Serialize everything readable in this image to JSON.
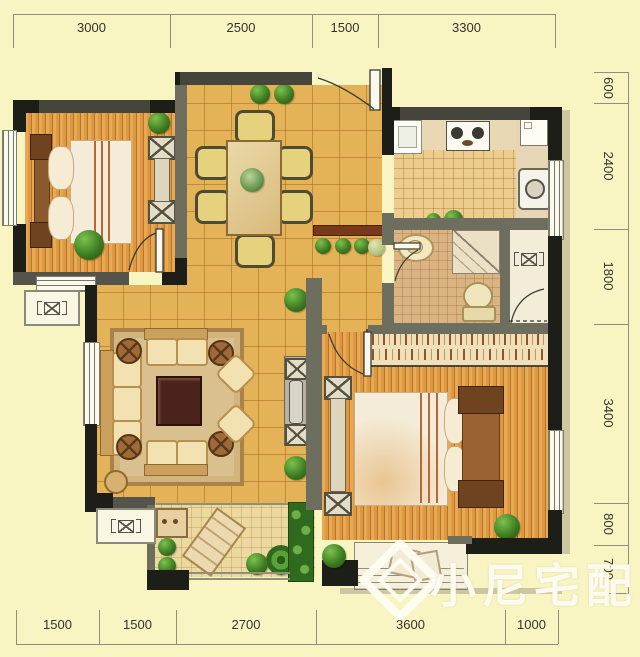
{
  "dimensions": {
    "top": [
      "3000",
      "2500",
      "1500",
      "3300"
    ],
    "right": [
      "600",
      "2400",
      "1800",
      "3400",
      "800",
      "700"
    ],
    "bottom": [
      "1500",
      "1500",
      "2700",
      "3600",
      "1000"
    ]
  },
  "watermark": {
    "text": "小尼宅配"
  },
  "colors": {
    "background": "#f9f5c3",
    "wall_exterior": "#1e1e18",
    "wall_interior": "#6e6e5f",
    "wood_floor": "#dd9840",
    "tile_floor": "#e4b257",
    "kitchen_tile": "#eccd8e",
    "bath_tile": "#dab483",
    "balcony_tile": "#ecd9a0",
    "plant_green": "#3f7d22",
    "watermark_cream": "#fffcf2"
  }
}
